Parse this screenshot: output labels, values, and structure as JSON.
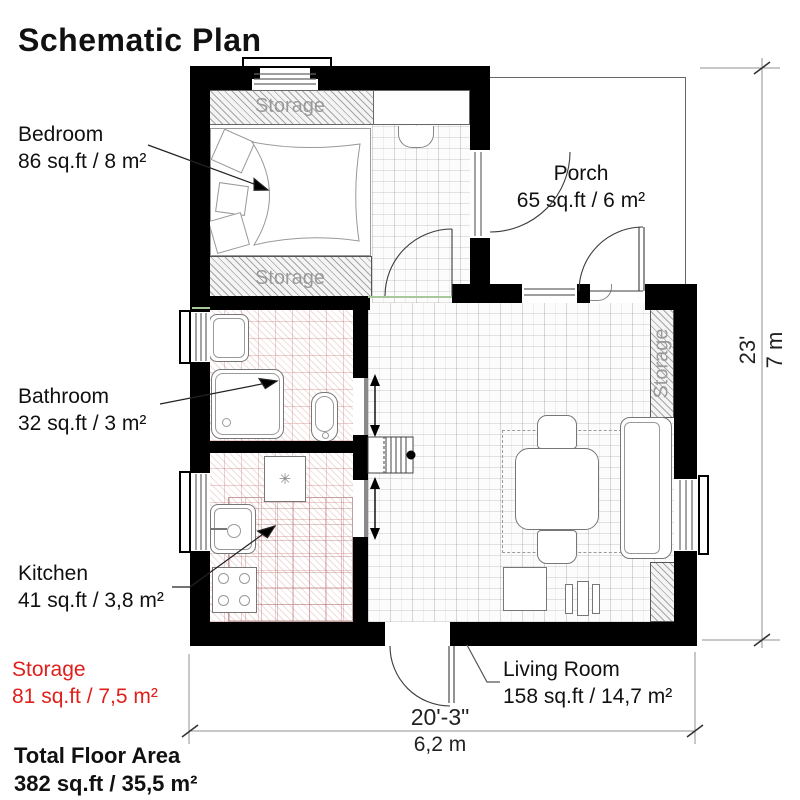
{
  "title": "Schematic Plan",
  "rooms": {
    "bedroom": {
      "name": "Bedroom",
      "area": "86 sq.ft / 8 m²"
    },
    "porch": {
      "name": "Porch",
      "area": "65 sq.ft / 6 m²"
    },
    "bathroom": {
      "name": "Bathroom",
      "area": "32 sq.ft / 3 m²"
    },
    "kitchen": {
      "name": "Kitchen",
      "area": "41 sq.ft / 3,8 m²"
    },
    "storage": {
      "name": "Storage",
      "area": "81 sq.ft / 7,5 m²"
    },
    "living_room": {
      "name": "Living Room",
      "area": "158 sq.ft / 14,7 m²"
    }
  },
  "total": {
    "name": "Total Floor Area",
    "area": "382 sq.ft / 35,5 m²"
  },
  "plan_labels": {
    "storage_top": "Storage",
    "storage_bottom": "Storage",
    "storage_side": "Storage"
  },
  "dimensions": {
    "height_ft": "23'",
    "height_m": "7 m",
    "width_ft": "20'-3\"",
    "width_m": "6,2 m"
  },
  "symbols": {
    "fridge_snowflake": "✳"
  },
  "colors": {
    "wall": "#000000",
    "label_red": "#e0201a",
    "plan_label_gray": "#9a9a9a",
    "tile_pink": "#c98181",
    "accent_green": "#a8c79a"
  }
}
